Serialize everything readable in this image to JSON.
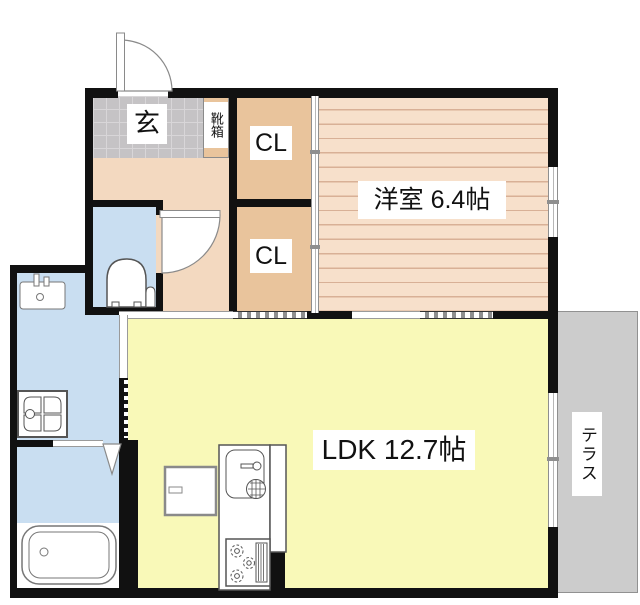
{
  "floorplan": {
    "rooms": {
      "genkan": {
        "label": "玄"
      },
      "shoebox": {
        "label": "靴箱"
      },
      "closet_upper": {
        "label": "CL"
      },
      "closet_lower": {
        "label": "CL"
      },
      "western_room": {
        "label": "洋室 6.4帖"
      },
      "ldk": {
        "label": "LDK 12.7帖"
      },
      "terrace": {
        "label": "テラス"
      }
    },
    "colors": {
      "wall_black": "#111111",
      "entry_tile": "#c5c3c5",
      "closet_tan": "#e9c49c",
      "hall_peach": "#f3d9c0",
      "western_floor": "#f7e0cb",
      "ldk_yellow": "#f9f9b8",
      "wet_room_blue": "#c9def1",
      "terrace_gray": "#cccccc"
    },
    "fixtures": [
      "entrance-door",
      "shoe-cabinet",
      "toilet",
      "washbasin",
      "washing-machine-pan",
      "bathtub",
      "kitchen-sink",
      "gas-stove",
      "refrigerator-space",
      "bath-folding-door",
      "sliding-doors",
      "windows"
    ]
  }
}
